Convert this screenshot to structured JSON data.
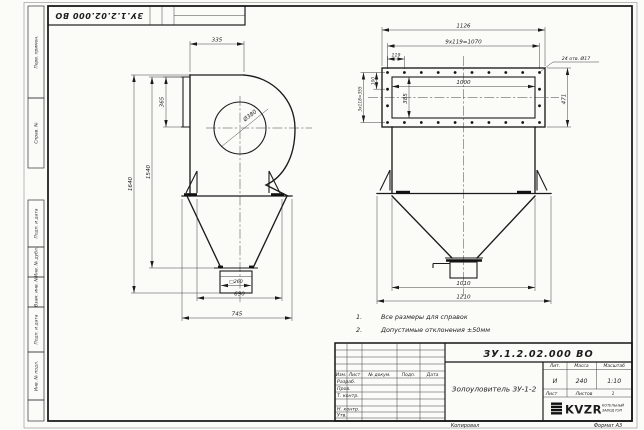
{
  "sheet": {
    "stamp_number": "ЗУ.1.2.02.000 ВО",
    "margin_labels": [
      "Перв. примен.",
      "Справ. №",
      "Подп. и дата",
      "Инв. № дубл.",
      "Взам. инв. №",
      "Подп. и дата",
      "Инв. № подл."
    ],
    "footer": {
      "copied": "Копировал",
      "format": "Формат А3"
    }
  },
  "notes": {
    "items": [
      {
        "num": "1.",
        "text": "Все размеры для справок"
      },
      {
        "num": "2.",
        "text": "Допустимые отклонения ±50мм"
      }
    ]
  },
  "front_view": {
    "dims": {
      "inlet_width": "335",
      "flange_height": "365",
      "scroll_diameter": "Ø380",
      "overall_height": "1640",
      "body_height": "1540",
      "outlet_square": "□260",
      "hopper_width": "690",
      "overall_width": "745"
    }
  },
  "side_view": {
    "dims": {
      "overall_width": "1126",
      "hole_spacing": "9x119=1070",
      "hole_pitch": "119",
      "side_hole_spacing": "3x118=355",
      "edge_offset": "100",
      "inner_width": "1000",
      "inner_height": "385",
      "flange_height": "471",
      "holes_note": "24 отв. Ø17",
      "hopper_inner_width": "1010",
      "hopper_overall_width": "1210"
    }
  },
  "title_block": {
    "doc_number": "ЗУ.1.2.02.000 ВО",
    "product_name": "Золоуловитель ЗУ-1-2",
    "col_headers": [
      "Изм.",
      "Лист",
      "№ докум.",
      "Подп.",
      "Дата"
    ],
    "row_labels": [
      "Разраб.",
      "Пров.",
      "Т. контр.",
      "Н. контр.",
      "Утв."
    ],
    "lit_label": "Лит.",
    "lit_value": "И",
    "mass_label": "Масса",
    "mass_value": "240",
    "scale_label": "Масштаб",
    "scale_value": "1:10",
    "sheet_label": "Лист",
    "sheets_label": "Листов",
    "sheets_value": "1",
    "logo_text": "KVZR",
    "logo_sub_line1": "КОТЕЛЬНЫЙ",
    "logo_sub_line2": "ЗАВОД РЭП"
  }
}
